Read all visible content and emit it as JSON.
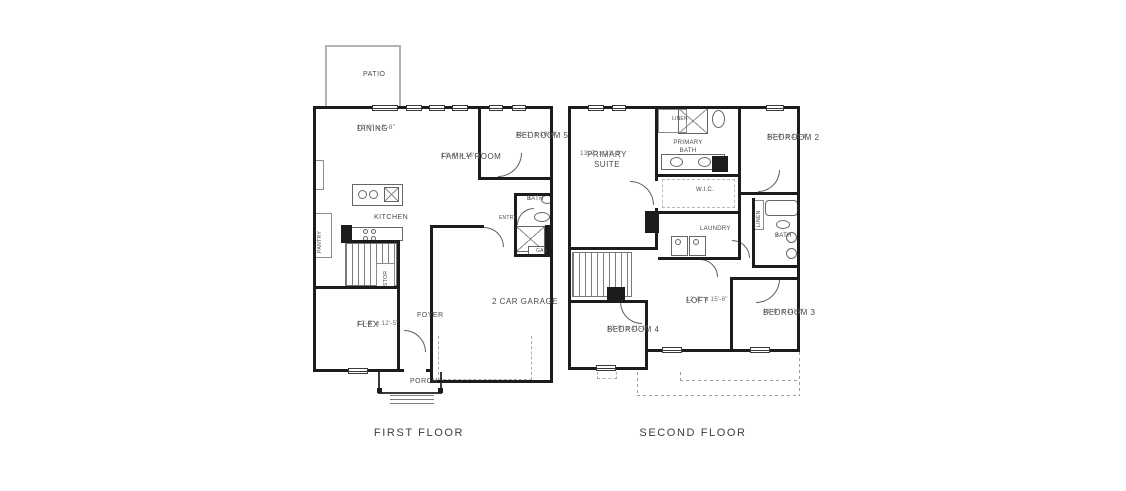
{
  "page": {
    "type": "floor-plan-sheet",
    "background": "#ffffff"
  },
  "colors": {
    "wall": "#1c1c1c",
    "line": "#5f5f5f",
    "dash": "#ababab",
    "label": "#4a4a4a",
    "bg": "#ffffff"
  },
  "plans": {
    "first": {
      "caption": "FIRST FLOOR",
      "rooms": {
        "patio": {
          "label": "PATIO"
        },
        "dining": {
          "label": "DINING",
          "dims": "12'-8\" x 8'-8\""
        },
        "family": {
          "label": "FAMILY ROOM",
          "dims": "13'-4\" x 18'-1\""
        },
        "bedroom5": {
          "label": "BEDROOM 5",
          "dims": "11'-1\" x 10'-4\""
        },
        "kitchen": {
          "label": "KITCHEN"
        },
        "pantry": {
          "label": "PANTRY"
        },
        "entry": {
          "label": "ENTRY"
        },
        "bath3": {
          "label": "BATH",
          "number": "3"
        },
        "stor": {
          "label": "STOR"
        },
        "gas": {
          "label": "GAS"
        },
        "flex": {
          "label": "FLEX",
          "dims": "12'-5\" x 12'-5\""
        },
        "foyer": {
          "label": "FOYER"
        },
        "garage": {
          "label": "2 CAR GARAGE"
        },
        "porch": {
          "label": "PORCH"
        }
      }
    },
    "second": {
      "caption": "SECOND FLOOR",
      "rooms": {
        "primary_suite": {
          "label": "PRIMARY SUITE",
          "dims": "13'-7\" x 21'-3\""
        },
        "linen": {
          "label": "LINEN"
        },
        "primary_bath": {
          "label": "PRIMARY BATH"
        },
        "bedroom2": {
          "label": "BEDROOM 2",
          "dims": "10'-8\" x 12'-1\""
        },
        "wic": {
          "label": "W.I.C."
        },
        "laundry": {
          "label": "LAUNDRY"
        },
        "linen2": {
          "label": "LINEN"
        },
        "bath2": {
          "label": "BATH",
          "number": "2"
        },
        "bedroom4": {
          "label": "BEDROOM 4",
          "dims": "12'-5\" x 11'-1\""
        },
        "loft": {
          "label": "LOFT",
          "dims": "12'-8\" x 15'-6\""
        },
        "bedroom3": {
          "label": "BEDROOM 3",
          "dims": "11'-8\" x 11'-2\""
        }
      }
    }
  }
}
